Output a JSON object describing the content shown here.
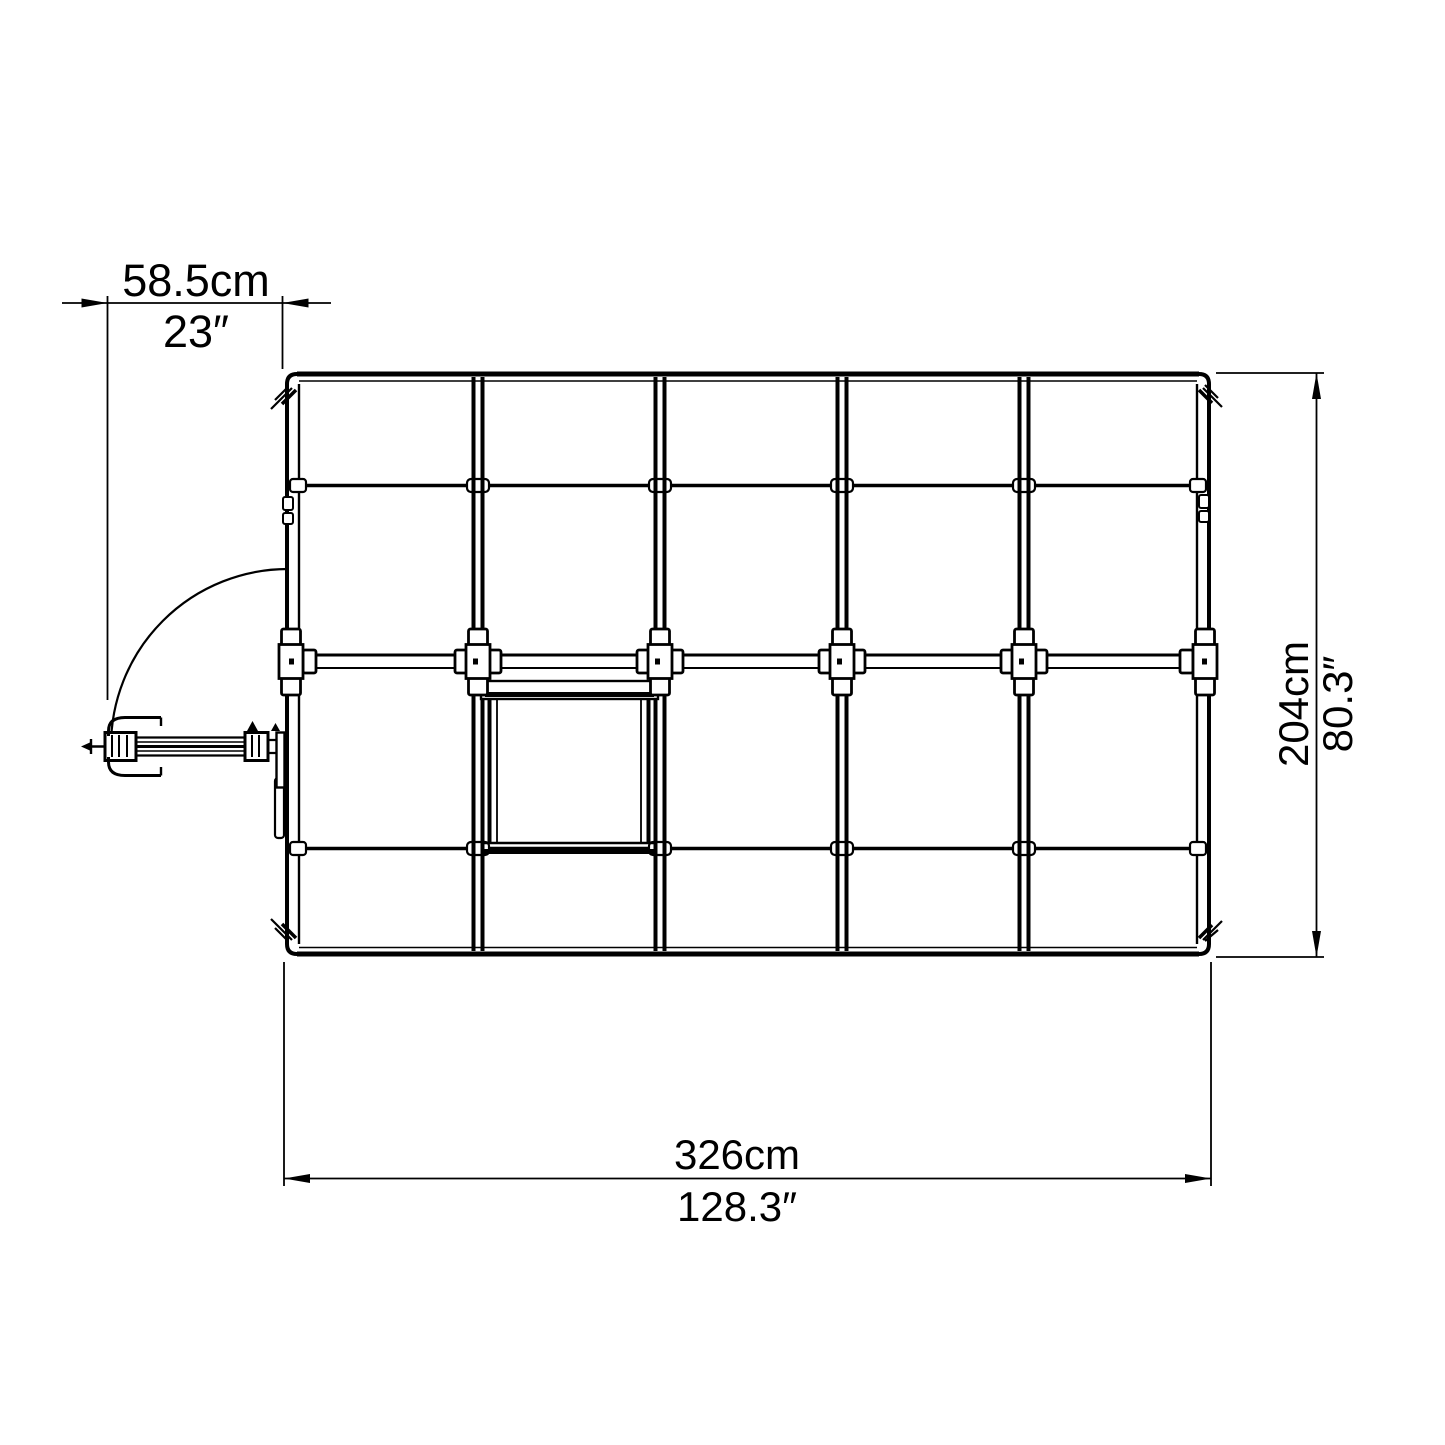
{
  "diagram": {
    "title": "greenhouse-top-view-dimension-drawing",
    "colors": {
      "line": "#000000",
      "background": "#ffffff"
    },
    "dimensions": {
      "door_width": {
        "metric": "58.5cm",
        "imperial": "23″"
      },
      "depth": {
        "metric": "204cm",
        "imperial": "80.3″"
      },
      "length": {
        "metric": "326cm",
        "imperial": "128.3″"
      }
    }
  }
}
